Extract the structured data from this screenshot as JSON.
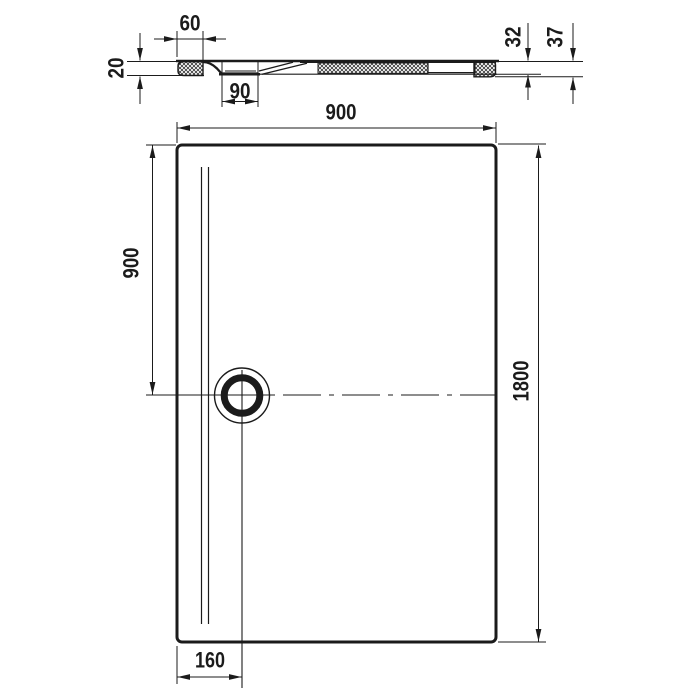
{
  "colors": {
    "ink": "#1b1b1b",
    "paper": "#ffffff"
  },
  "section_view": {
    "rim_width": "60",
    "rim_thickness": "20",
    "drain_recess_width": "90",
    "height_body": "32",
    "height_overall": "37"
  },
  "plan_view": {
    "width": "900",
    "drain_center_from_top": "900",
    "length": "1800",
    "drain_center_from_left": "160"
  }
}
